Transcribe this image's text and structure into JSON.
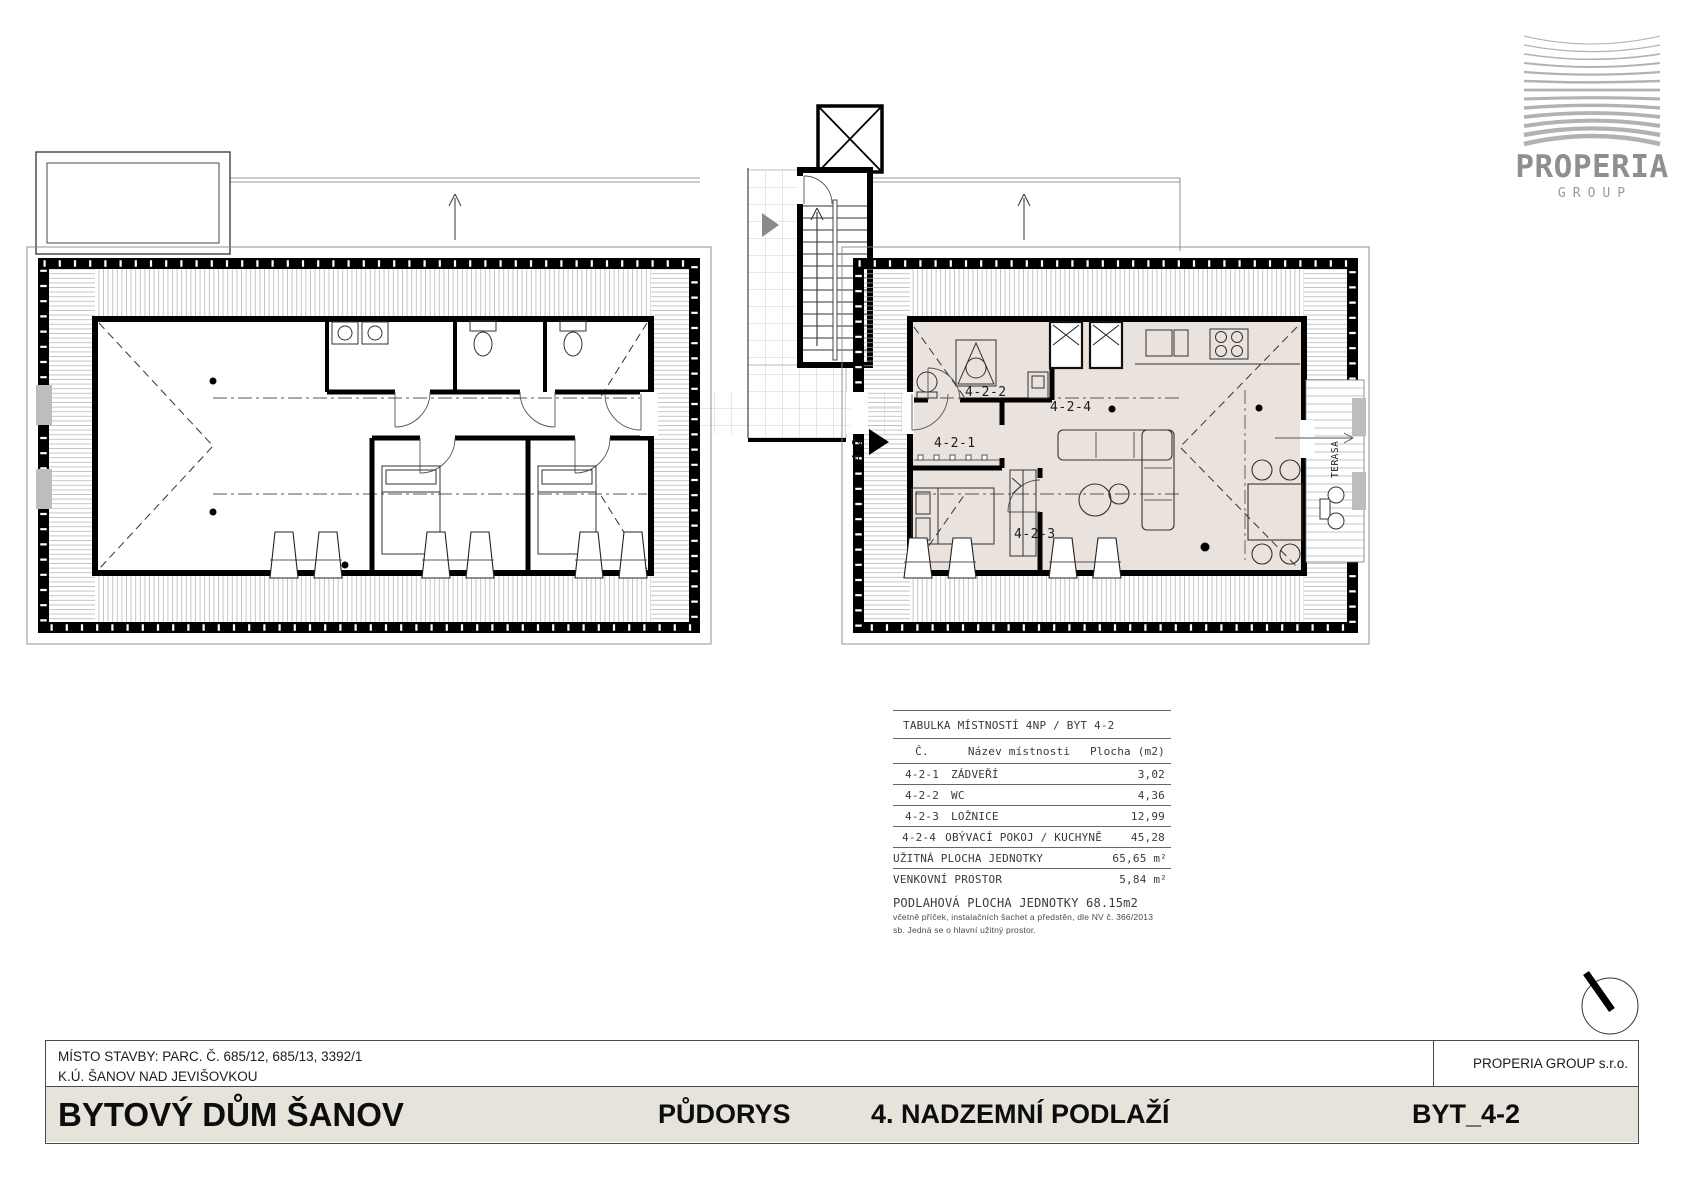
{
  "logo": {
    "name": "PROPERIA",
    "subtitle": "GROUP"
  },
  "plan": {
    "labels": {
      "unit_entry": "4-2",
      "room1": "4-2-1",
      "room2": "4-2-2",
      "room3": "4-2-3",
      "room4": "4-2-4",
      "terrace": "TERASA"
    }
  },
  "room_table": {
    "title": "TABULKA MÍSTNOSTÍ 4NP / BYT 4-2",
    "columns": {
      "num": "Č.",
      "name": "Název místnosti",
      "area": "Plocha (m2)"
    },
    "rows": [
      {
        "num": "4-2-1",
        "name": "ZÁDVEŘÍ",
        "area": "3,02"
      },
      {
        "num": "4-2-2",
        "name": "WC",
        "area": "4,36"
      },
      {
        "num": "4-2-3",
        "name": "LOŽNICE",
        "area": "12,99"
      },
      {
        "num": "4-2-4",
        "name": "OBÝVACÍ POKOJ / KUCHYNĚ",
        "area": "45,28"
      }
    ],
    "summary": [
      {
        "label": "UŽITNÁ PLOCHA JEDNOTKY",
        "value": "65,65 m²"
      },
      {
        "label": "VENKOVNÍ PROSTOR",
        "value": "5,84 m²"
      }
    ],
    "footer_title": "PODLAHOVÁ PLOCHA JEDNOTKY 68.15m2",
    "footer_note1": "včetně příček, instalačních šachet a předstěn, dle NV č. 366/2013",
    "footer_note2": "sb. Jedná se o hlavní užitný prostor."
  },
  "title_block": {
    "site_line1": "MÍSTO STAVBY: PARC. Č. 685/12, 685/13, 3392/1",
    "site_line2": "K.Ú. ŠANOV NAD JEVIŠOVKOU",
    "company": "PROPERIA GROUP s.r.o.",
    "project": "BYTOVÝ DŮM ŠANOV",
    "drawing": "PŮDORYS",
    "floor": "4. NADZEMNÍ PODLAŽÍ",
    "unit": "BYT_4-2"
  },
  "colors": {
    "apartment_fill": "#eae2dd",
    "titlebar_fill": "#e6e3da",
    "logo_gray": "#8f8f8f",
    "hatch_gray": "#adadad"
  }
}
